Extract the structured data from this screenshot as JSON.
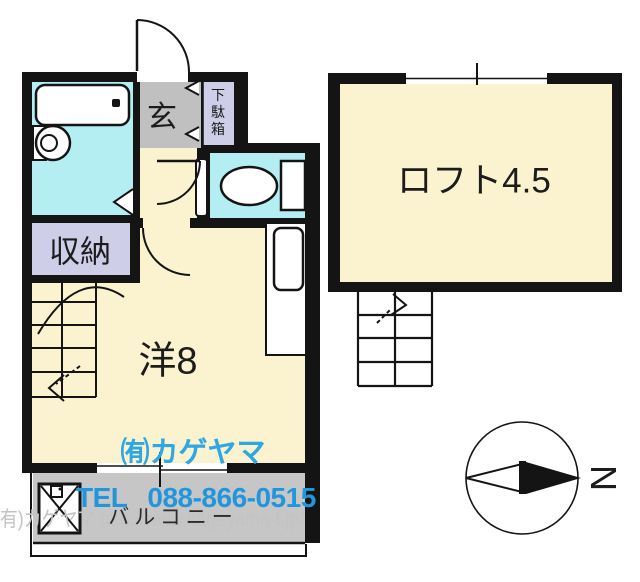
{
  "floorplan": {
    "room_labels": {
      "entrance": "玄",
      "shoe_cabinet": "下駄箱",
      "storage": "収納",
      "western_room": "洋8",
      "loft": "ロフト4.5",
      "balcony": "バルコニー"
    },
    "compass": {
      "north_label": "N"
    },
    "colors": {
      "room_floor": "#FBF3D0",
      "wet_area": "#B4EEF3",
      "storage_area": "#CFCEE9",
      "entrance_floor": "#C0C0C0",
      "balcony_floor": "#C6C6C6",
      "wall": "#141414",
      "accent_blue": "#2196DD",
      "company_cyan": "#2FA7E3",
      "watermark_gray": "#C3C3C3"
    }
  },
  "branding": {
    "company_name": "㈲カゲヤマ",
    "tel_label": "TEL",
    "phone_number": "088-866-0515",
    "watermark_text": "(有)カゲヤマ http://www.kageyama-f.jp/"
  }
}
